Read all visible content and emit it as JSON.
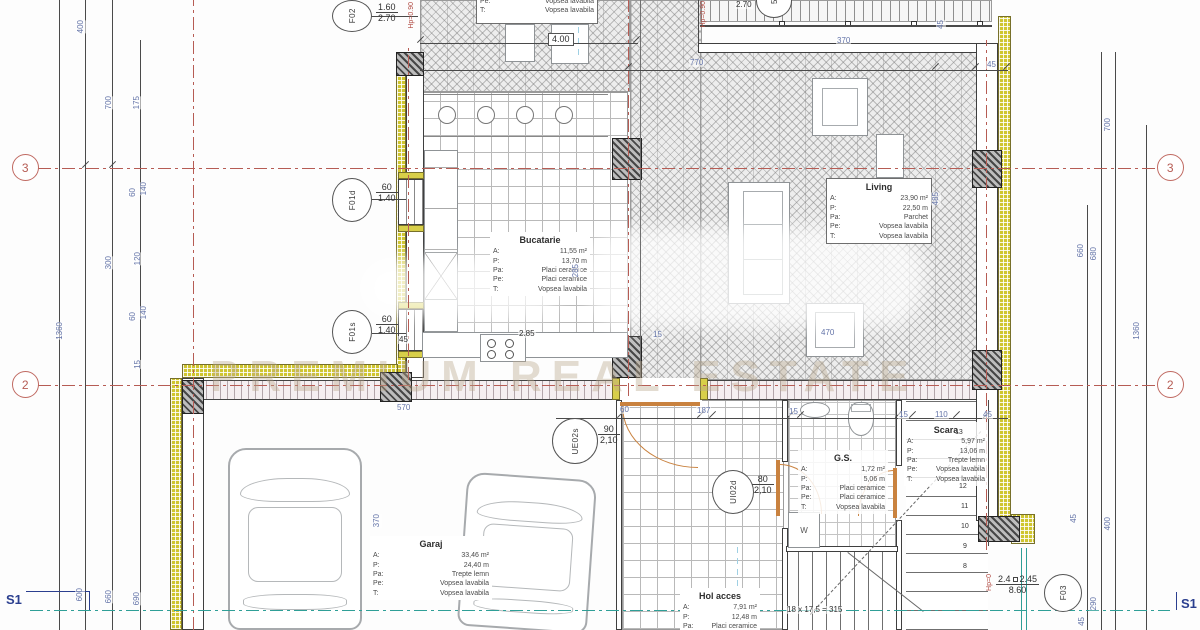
{
  "watermark": {
    "tagline": "PREMIUM REAL ESTATE"
  },
  "axes": {
    "a3": "3",
    "a2": "2"
  },
  "section": {
    "label": "S1"
  },
  "colors": {
    "axis_red": "#b65c54",
    "dim_blue": "#6474a8",
    "insulation": "#cfc52f",
    "teal": "#2f9f97",
    "door_orange": "#c9823f",
    "wall_dark": "#3f3f3f"
  },
  "rooms": {
    "top_partial": {
      "specs": [
        {
          "k": "Pe:",
          "v": "Vopsea lavabila"
        },
        {
          "k": "T:",
          "v": "Vopsea lavabila"
        }
      ]
    },
    "living": {
      "title": "Living",
      "specs": [
        {
          "k": "A:",
          "v": "23,90 m²"
        },
        {
          "k": "P:",
          "v": "22,50 m"
        },
        {
          "k": "Pa:",
          "v": "Parchet"
        },
        {
          "k": "Pe:",
          "v": "Vopsea lavabila"
        },
        {
          "k": "T:",
          "v": "Vopsea lavabila"
        }
      ]
    },
    "bucatarie": {
      "title": "Bucatarie",
      "specs": [
        {
          "k": "A:",
          "v": "11,55 m²"
        },
        {
          "k": "P:",
          "v": "13,70 m"
        },
        {
          "k": "Pa:",
          "v": "Placi ceramice"
        },
        {
          "k": "Pe:",
          "v": "Placi ceramice"
        },
        {
          "k": "T:",
          "v": "Vopsea lavabila"
        }
      ]
    },
    "garaj": {
      "title": "Garaj",
      "specs": [
        {
          "k": "A:",
          "v": "33,46 m²"
        },
        {
          "k": "P:",
          "v": "24,40 m"
        },
        {
          "k": "Pa:",
          "v": "Trepte lemn"
        },
        {
          "k": "Pe:",
          "v": "Vopsea lavabila"
        },
        {
          "k": "T:",
          "v": "Vopsea lavabila"
        }
      ]
    },
    "hol": {
      "title": "Hol acces",
      "specs": [
        {
          "k": "A:",
          "v": "7,91 m²"
        },
        {
          "k": "P:",
          "v": "12,48 m"
        },
        {
          "k": "Pa:",
          "v": "Placi ceramice"
        }
      ]
    },
    "gs": {
      "title": "G.S.",
      "specs": [
        {
          "k": "A:",
          "v": "1,72 m²"
        },
        {
          "k": "P:",
          "v": "5,06 m"
        },
        {
          "k": "Pa:",
          "v": "Placi ceramice"
        },
        {
          "k": "Pe:",
          "v": "Placi ceramice"
        },
        {
          "k": "T:",
          "v": "Vopsea lavabila"
        }
      ]
    },
    "scara": {
      "title": "Scara",
      "specs": [
        {
          "k": "A:",
          "v": "5,97 m²"
        },
        {
          "k": "P:",
          "v": "13,06 m"
        },
        {
          "k": "Pa:",
          "v": "Trepte lemn"
        },
        {
          "k": "Pe:",
          "v": "Vopsea lavabila"
        },
        {
          "k": "T:",
          "v": "Vopsea lavabila"
        }
      ]
    }
  },
  "openings": {
    "f02": {
      "label": "F02",
      "w": "1.60",
      "h": "2.70"
    },
    "f01d": {
      "label": "F01d",
      "w": "60",
      "h": "1.40"
    },
    "f01s": {
      "label": "F01s",
      "w": "60",
      "h": "1.40"
    },
    "f03": {
      "label": "F03",
      "v1": "2.4",
      "v2": "2.45",
      "h": "8.60"
    },
    "ue02s": {
      "label": "UE02s",
      "w": "90",
      "h": "2,10"
    },
    "ui02d": {
      "label": "UI02d",
      "w": "80",
      "h": "2,10"
    },
    "terrace_step": {
      "label": "5"
    }
  },
  "gs_items": {
    "washer": "W"
  },
  "stair": {
    "formula": "18 x 17,5 = 315",
    "numbers": [
      {
        "t": "13",
        "x": 955,
        "y": 429
      },
      {
        "t": "12",
        "x": 959,
        "y": 483
      },
      {
        "t": "11",
        "x": 961,
        "y": 503
      },
      {
        "t": "10",
        "x": 961,
        "y": 523
      },
      {
        "t": "9",
        "x": 963,
        "y": 543
      },
      {
        "t": "8",
        "x": 963,
        "y": 563
      }
    ]
  },
  "red_notes": [
    {
      "t": "Hp=0.90",
      "x": 408,
      "y": 2
    },
    {
      "t": "Hp=0.90",
      "x": 700,
      "y": 1
    },
    {
      "t": "Hp=0",
      "x": 986,
      "y": 574
    }
  ],
  "dims": [
    {
      "t": "400",
      "x": 76,
      "y": 20,
      "rot": 1
    },
    {
      "t": "700",
      "x": 104,
      "y": 96,
      "rot": 1
    },
    {
      "t": "175",
      "x": 132,
      "y": 96,
      "rot": 1
    },
    {
      "t": "140",
      "x": 139,
      "y": 182,
      "rot": 1
    },
    {
      "t": "60",
      "x": 128,
      "y": 188,
      "rot": 1
    },
    {
      "t": "120",
      "x": 133,
      "y": 252,
      "rot": 1
    },
    {
      "t": "300",
      "x": 104,
      "y": 256,
      "rot": 1
    },
    {
      "t": "1360",
      "x": 55,
      "y": 322,
      "rot": 1
    },
    {
      "t": "140",
      "x": 139,
      "y": 306,
      "rot": 1
    },
    {
      "t": "60",
      "x": 128,
      "y": 312,
      "rot": 1
    },
    {
      "t": "15",
      "x": 133,
      "y": 360,
      "rot": 1
    },
    {
      "t": "370",
      "x": 372,
      "y": 514,
      "rot": 1
    },
    {
      "t": "600",
      "x": 75,
      "y": 588,
      "rot": 1
    },
    {
      "t": "660",
      "x": 104,
      "y": 590,
      "rot": 1
    },
    {
      "t": "690",
      "x": 132,
      "y": 592,
      "rot": 1
    },
    {
      "t": "700",
      "x": 1103,
      "y": 118,
      "rot": 1
    },
    {
      "t": "660",
      "x": 1076,
      "y": 244,
      "rot": 1
    },
    {
      "t": "680",
      "x": 1089,
      "y": 247,
      "rot": 1
    },
    {
      "t": "1360",
      "x": 1132,
      "y": 322,
      "rot": 1
    },
    {
      "t": "45",
      "x": 1069,
      "y": 514,
      "rot": 1
    },
    {
      "t": "400",
      "x": 1103,
      "y": 517,
      "rot": 1
    },
    {
      "t": "290",
      "x": 1089,
      "y": 597,
      "rot": 1
    },
    {
      "t": "45",
      "x": 1077,
      "y": 617,
      "rot": 1
    },
    {
      "t": "2.70",
      "x": 735,
      "y": 1,
      "cls": "black"
    },
    {
      "t": "370",
      "x": 836,
      "y": 37
    },
    {
      "t": "770",
      "x": 689,
      "y": 59
    },
    {
      "t": "45",
      "x": 986,
      "y": 61
    },
    {
      "t": "45",
      "x": 936,
      "y": 20,
      "rot": 1
    },
    {
      "t": "4.00",
      "x": 548,
      "y": 33,
      "cls": "black boxed"
    },
    {
      "t": "285",
      "x": 571,
      "y": 264,
      "rot": 1
    },
    {
      "t": "2.85",
      "x": 518,
      "y": 330,
      "cls": "black"
    },
    {
      "t": "45",
      "x": 398,
      "y": 336,
      "cls": "black"
    },
    {
      "t": "470",
      "x": 820,
      "y": 329
    },
    {
      "t": "15",
      "x": 652,
      "y": 331
    },
    {
      "t": "485",
      "x": 931,
      "y": 192,
      "rot": 1
    },
    {
      "t": "570",
      "x": 396,
      "y": 404
    },
    {
      "t": "60",
      "x": 619,
      "y": 406
    },
    {
      "t": "187",
      "x": 696,
      "y": 407
    },
    {
      "t": "15",
      "x": 788,
      "y": 408
    },
    {
      "t": "15",
      "x": 898,
      "y": 411
    },
    {
      "t": "110",
      "x": 934,
      "y": 411
    },
    {
      "t": "45",
      "x": 982,
      "y": 411
    }
  ]
}
